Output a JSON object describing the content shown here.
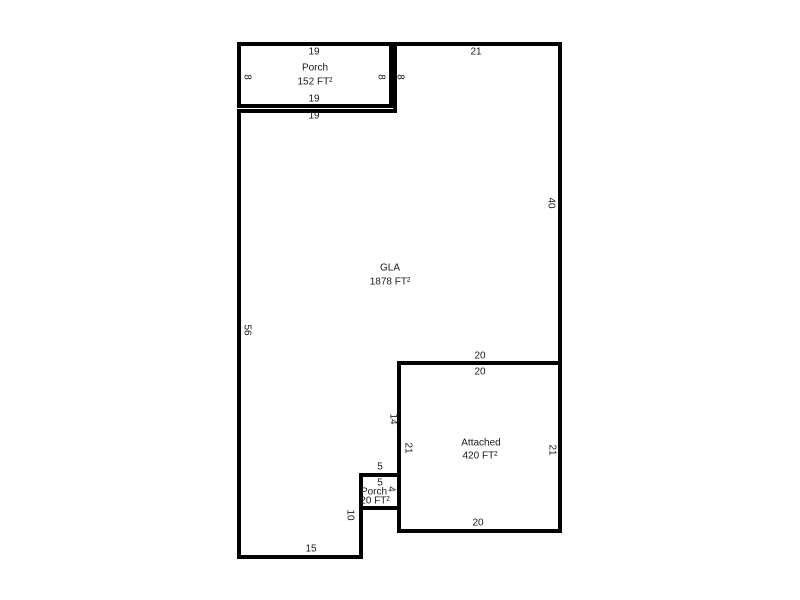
{
  "plan": {
    "colors": {
      "line": "#000000",
      "text": "#1b1b1b",
      "background": "#ffffff"
    },
    "areas": {
      "porch_top": {
        "label": "Porch",
        "area": "152 FT²"
      },
      "gla": {
        "label": "GLA",
        "area": "1878 FT²"
      },
      "attached": {
        "label": "Attached",
        "area": "420 FT²"
      },
      "porch_small": {
        "label": "Porch",
        "area": "20 FT²"
      }
    },
    "dims": {
      "porch_top_width": "19",
      "porch_left_height": "8",
      "porch_right_height": "8",
      "gla_west_upper_height": "8",
      "porch_bottom_width": "19",
      "gla_top_left_width": "19",
      "top_right_width": "21",
      "right_upper_height": "40",
      "left_side_height": "56",
      "gla_bottom_right_width": "20",
      "attached_top_width": "20",
      "gla_east_lower_height": "14",
      "attached_left_height": "21",
      "attached_right_height": "21",
      "gla_step_width": "5",
      "porch_small_top_width": "5",
      "porch_small_right_height": "4",
      "gla_porch_side_height": "10",
      "attached_bottom_width": "20",
      "gla_bottom_width": "15"
    }
  }
}
